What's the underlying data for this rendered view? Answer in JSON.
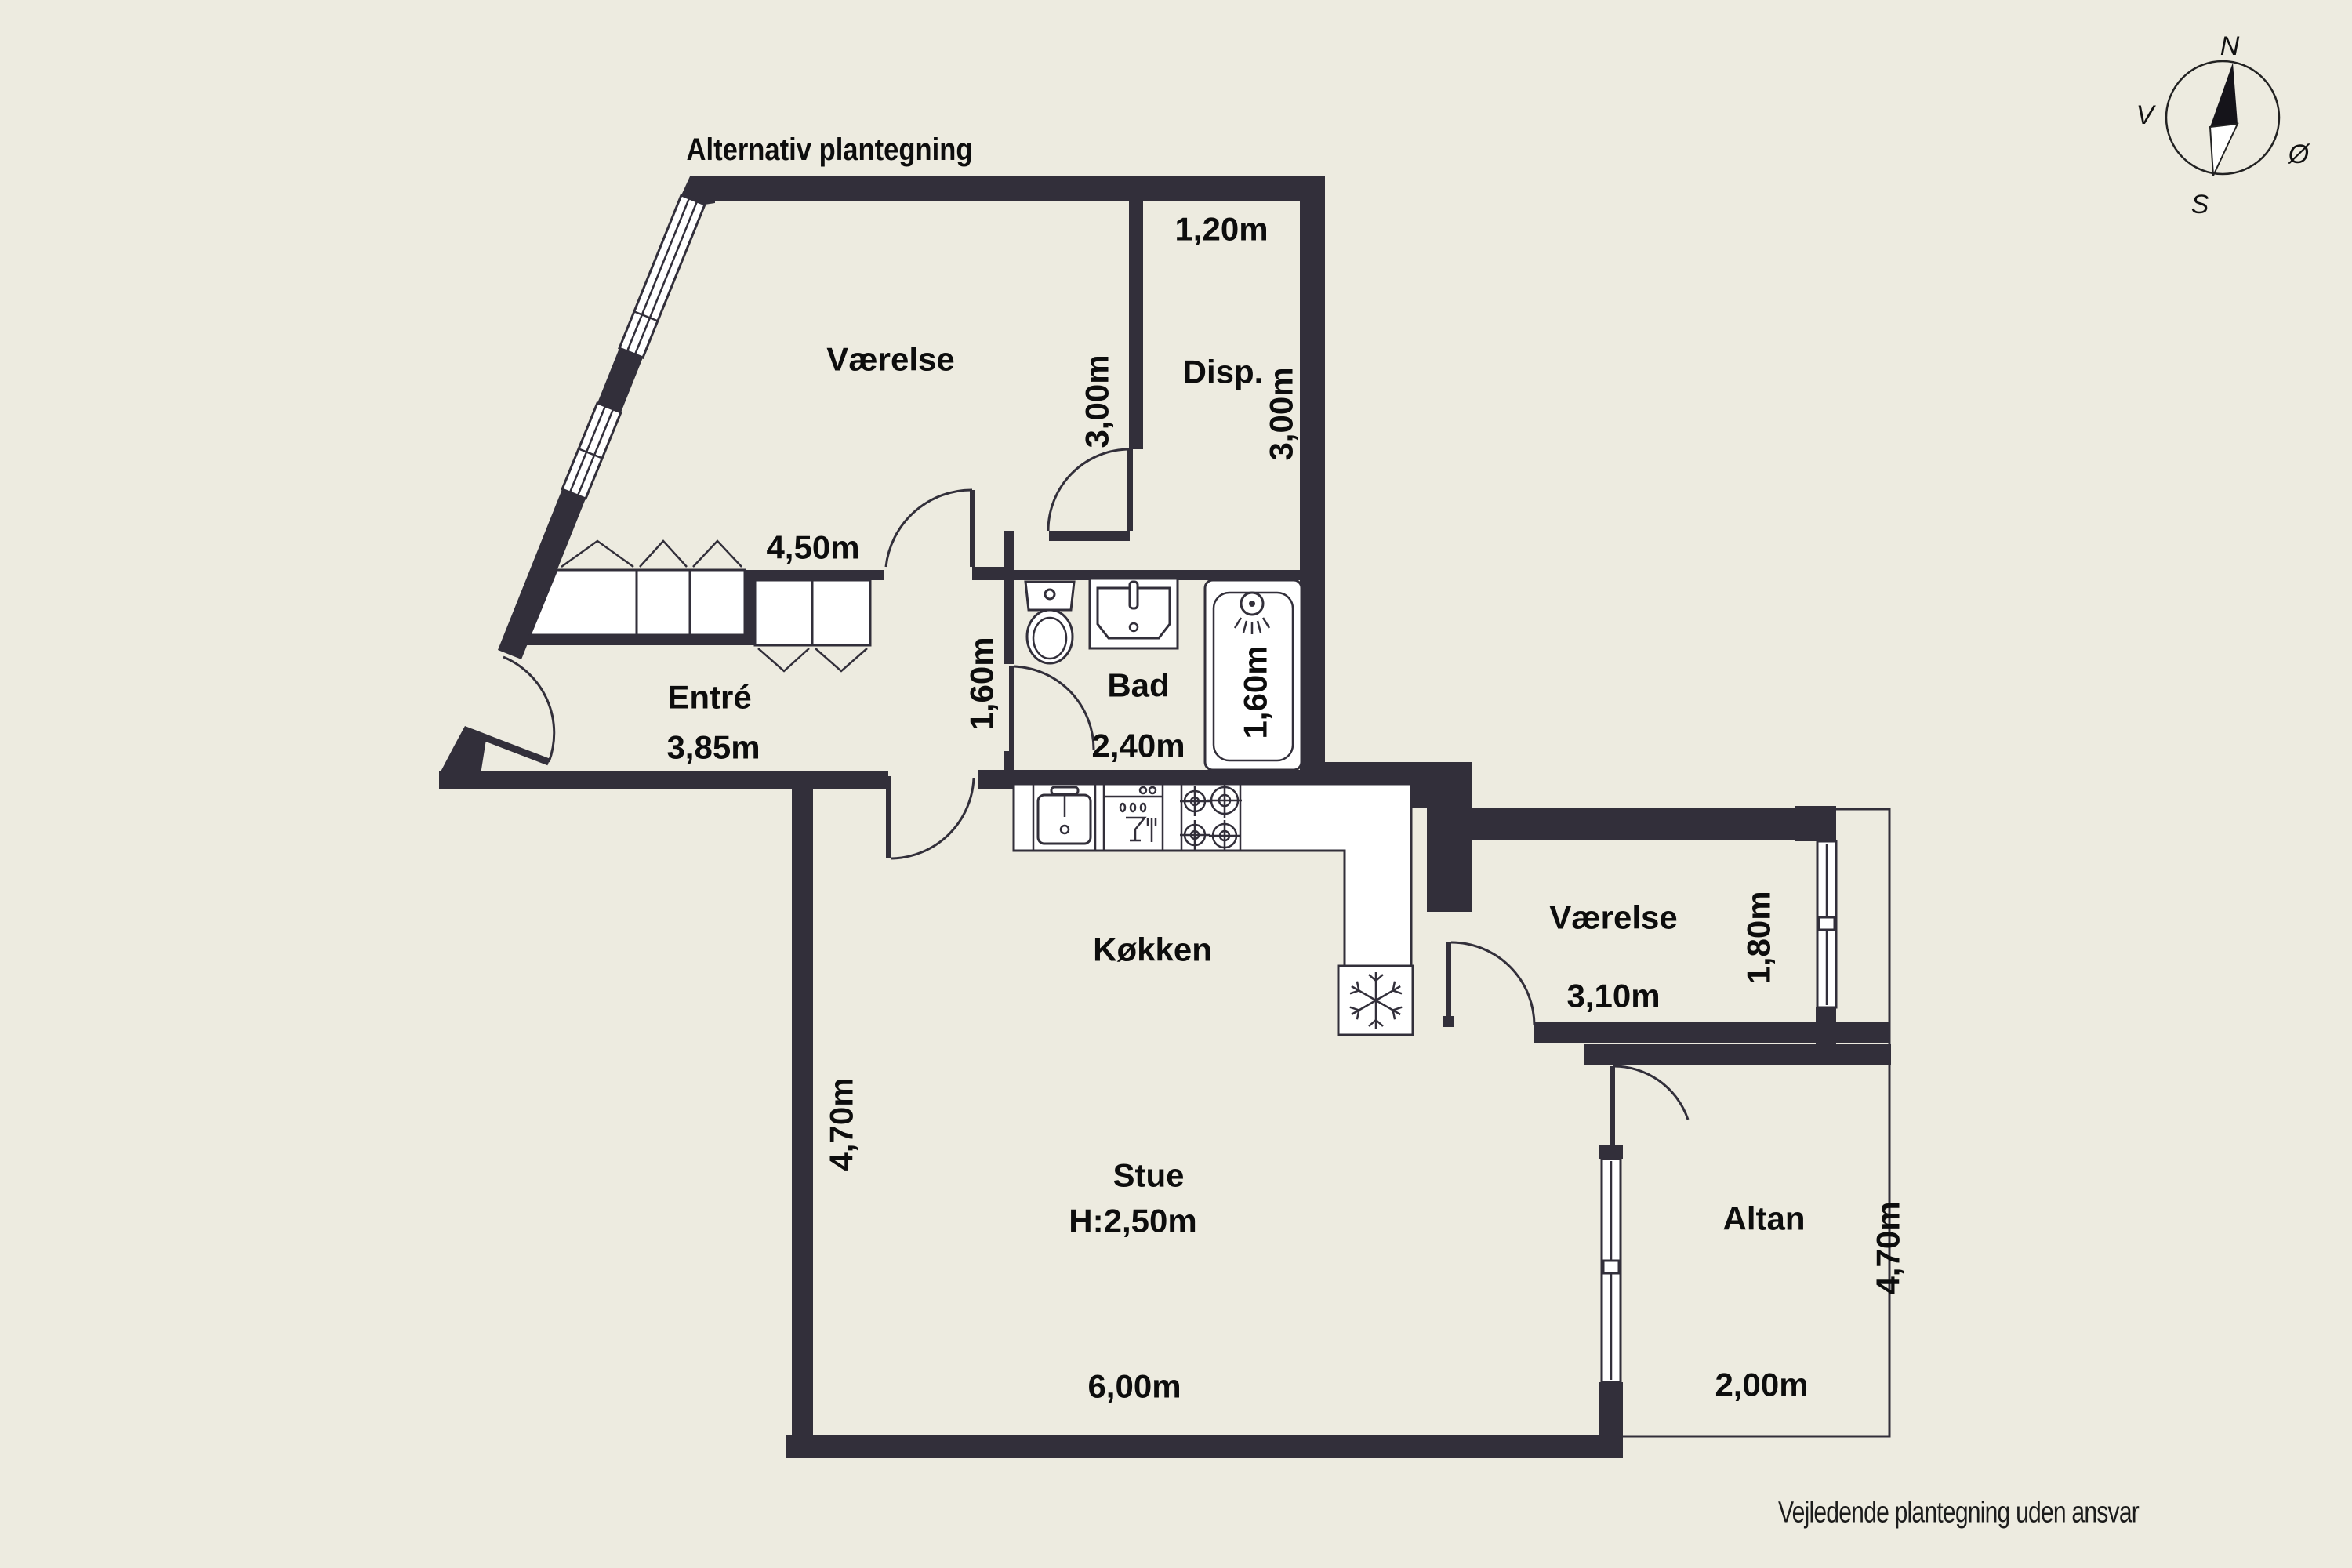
{
  "title": "Alternativ plantegning",
  "disclaimer": "Vejledende plantegning uden ansvar",
  "compass": {
    "north": "N",
    "south": "S",
    "west": "V",
    "east": "Ø"
  },
  "rooms": {
    "bedroom_top": {
      "name": "Værelse",
      "width": "4,50m",
      "depth": "3,00m"
    },
    "storage": {
      "name": "Disp.",
      "width": "1,20m",
      "depth": "3,00m"
    },
    "hall": {
      "name": "Entré",
      "width": "3,85m",
      "passage": "1,60m"
    },
    "bath": {
      "name": "Bad",
      "width": "2,40m",
      "tub": "1,60m"
    },
    "kitchen": {
      "name": "Køkken"
    },
    "bedroom_right": {
      "name": "Værelse",
      "width": "3,10m",
      "window": "1,80m"
    },
    "living": {
      "name": "Stue",
      "ceiling": "H:2,50m",
      "width": "6,00m",
      "depth": "4,70m"
    },
    "balcony": {
      "name": "Altan",
      "width": "2,00m",
      "depth": "4,70m"
    }
  }
}
